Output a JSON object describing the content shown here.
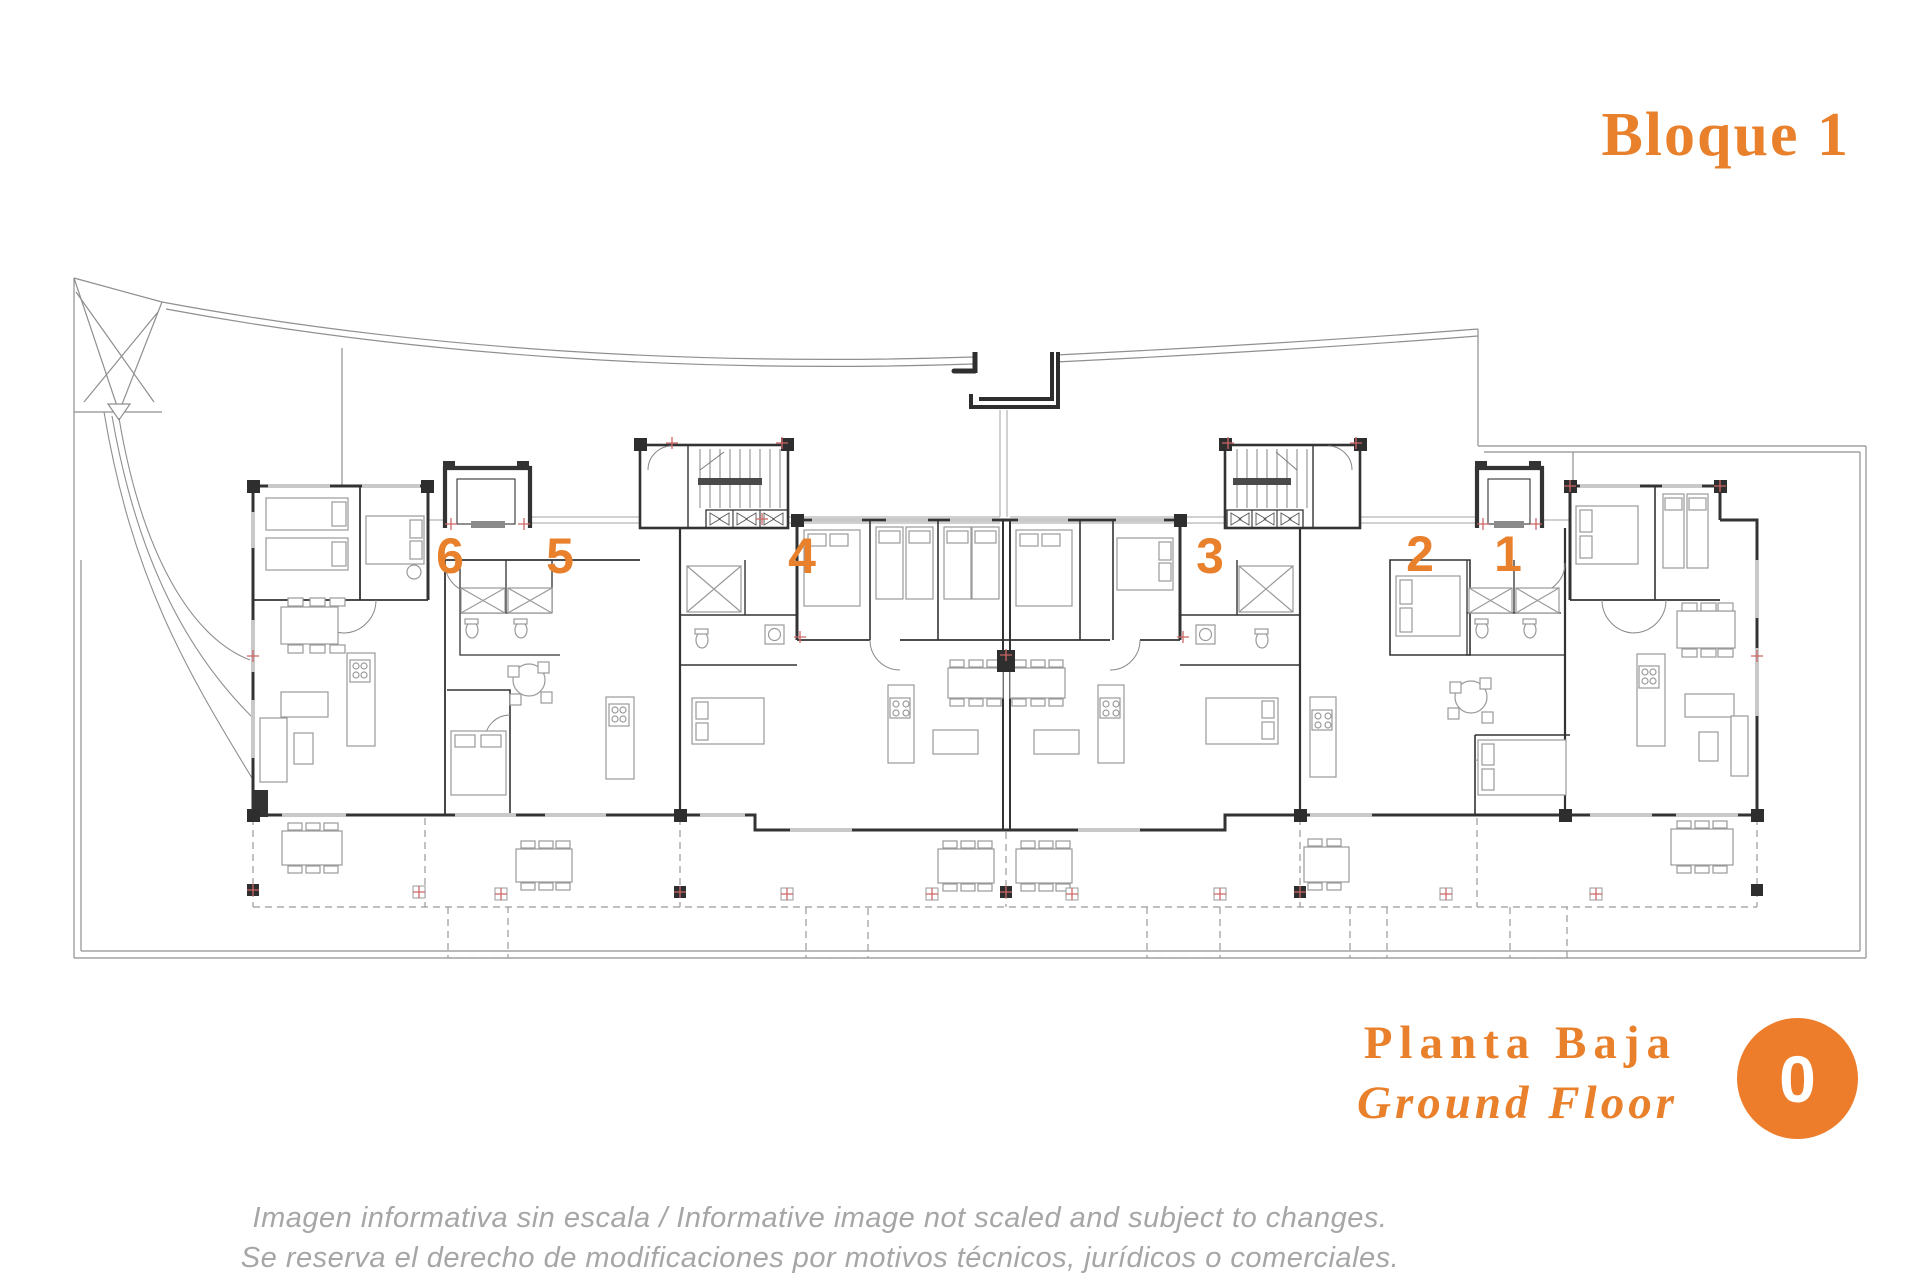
{
  "header": {
    "title": "Bloque 1"
  },
  "plan": {
    "units": [
      "6",
      "5",
      "4",
      "3",
      "2",
      "1"
    ]
  },
  "floor_label": {
    "primary": "Planta Baja",
    "secondary": "Ground Floor",
    "badge": "0"
  },
  "disclaimer": {
    "line1": "Imagen informativa sin escala /  Informative image not scaled and subject to changes.",
    "line2": "Se reserva el derecho de modificaciones por motivos técnicos, jurídicos o comerciales."
  },
  "colors": {
    "accent_orange": "#e8802c",
    "badge_orange": "#ed7d2b",
    "badge_text": "#ffffff",
    "disclaimer_gray": "#a6a6a6",
    "wall_dark": "#333333",
    "site_gray": "#8f8f8f",
    "furniture_gray": "#9a9a9a",
    "column_marker_red": "#cc6666"
  }
}
